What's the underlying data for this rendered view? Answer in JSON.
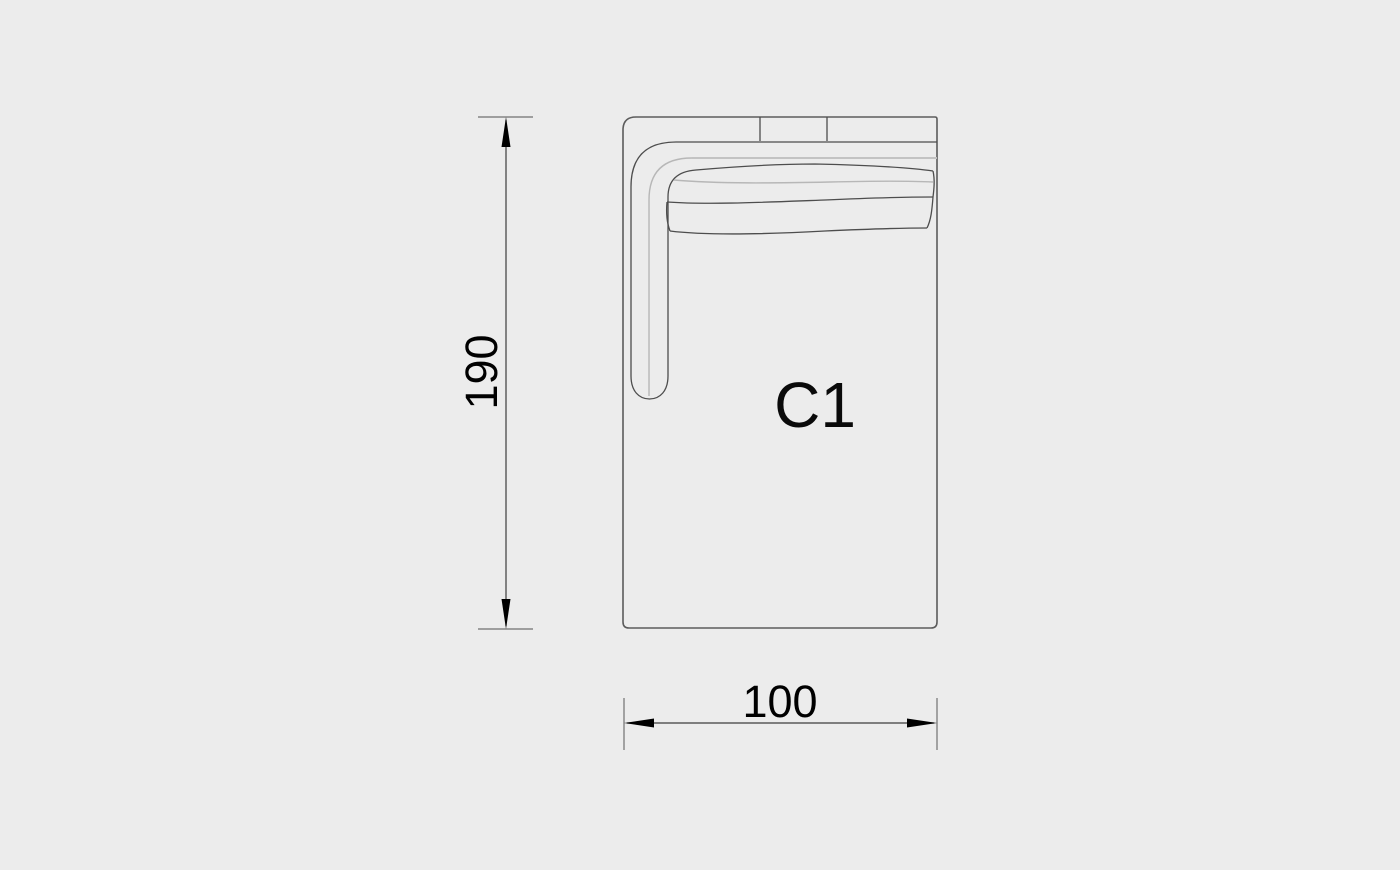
{
  "canvas": {
    "width_px": 1400,
    "height_px": 870,
    "background": "#ececec"
  },
  "diagram": {
    "module_label": "C1"
  },
  "dimensions": {
    "height_label": "190",
    "width_label": "100"
  },
  "colors": {
    "background": "#ececec",
    "outline_dark": "#4d4d4d",
    "outline_light": "#c3c3c3",
    "dimension_black": "#000000"
  }
}
